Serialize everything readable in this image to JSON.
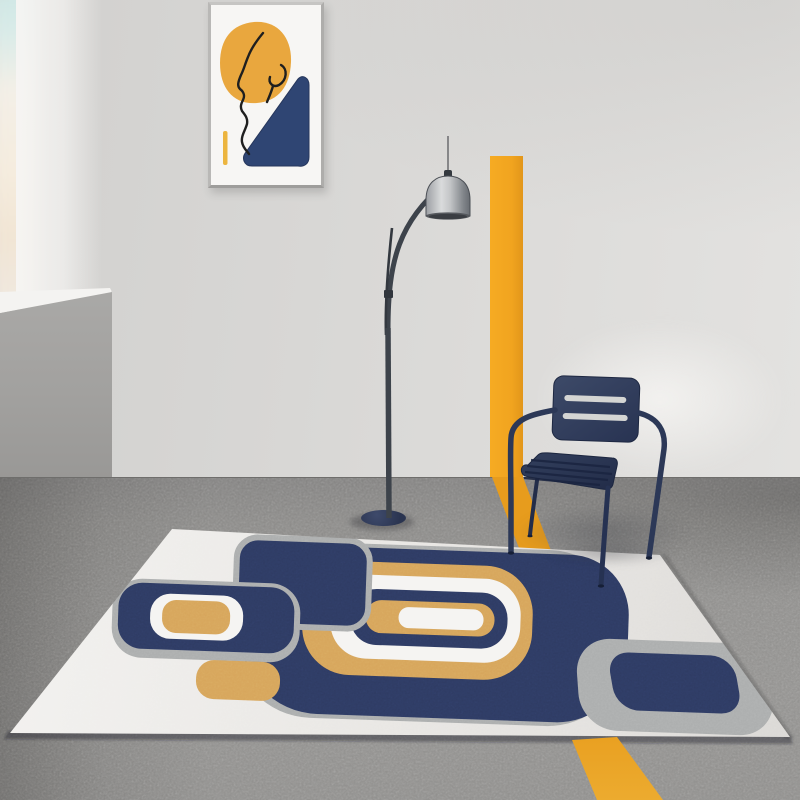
{
  "scene": {
    "title": "Modern abstract area rug in styled room",
    "objects": [
      "wall-art-print",
      "blurred-foreground-plant",
      "half-wall-ledge",
      "yellow-wall-stripe",
      "adjustable-floor-lamp",
      "navy-metal-armchair",
      "abstract-area-rug",
      "gray-carpet-floor",
      "yellow-floor-stripe"
    ],
    "rug_motifs": [
      "left-medallion-navy-white-tan",
      "top-left-navy-rounded-rect",
      "central-navy-blob",
      "concentric-tan-white-navy-rings",
      "small-tan-tab",
      "right-gray-ring-navy-center"
    ]
  },
  "colors": {
    "wall": "#d8d7d5",
    "wallLight": "#e3e2e0",
    "halfFace": "#a5a4a2",
    "halfTop": "#f4f3f1",
    "floor": "#8c8b89",
    "rugBase": "#eae8e5",
    "rugNavy": "#2e3b63",
    "rugTan": "#d7a55b",
    "rugGray": "#acaeae",
    "rugWhite": "#f5f4f2",
    "yellow": "#f1a41f",
    "chairNavy": "#32405f",
    "lampDark": "#3d434b",
    "lampShade": "#c6c8ca",
    "lampBase": "#2a3450",
    "artYellow": "#e9a73e",
    "artNavy": "#2f4573",
    "artLine": "#1f1f1f",
    "frameWhite": "#f7f6f4"
  }
}
